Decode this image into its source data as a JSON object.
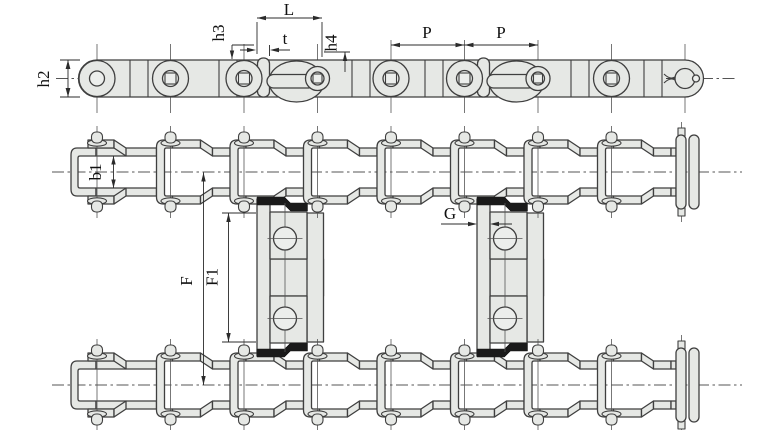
{
  "drawing": {
    "type": "roller-conveyor-chain-with-attachments-technical-drawing",
    "views": [
      "side-elevation",
      "plan-view-two-strands-with-cross-attachments"
    ]
  },
  "labels": {
    "h2": "h2",
    "L": "L",
    "t": "t",
    "h3": "h3",
    "h4": "h4",
    "p_left": "P",
    "p_right": "P",
    "b1": "b1",
    "F": "F",
    "F1": "F1",
    "G": "G"
  },
  "colors": {
    "plate": "#e6e8e5",
    "outline": "#3f3f3f",
    "dim": "#2b2b2b",
    "cl": "#555555",
    "joint": "#1a1a1a",
    "bg": "#ffffff"
  }
}
